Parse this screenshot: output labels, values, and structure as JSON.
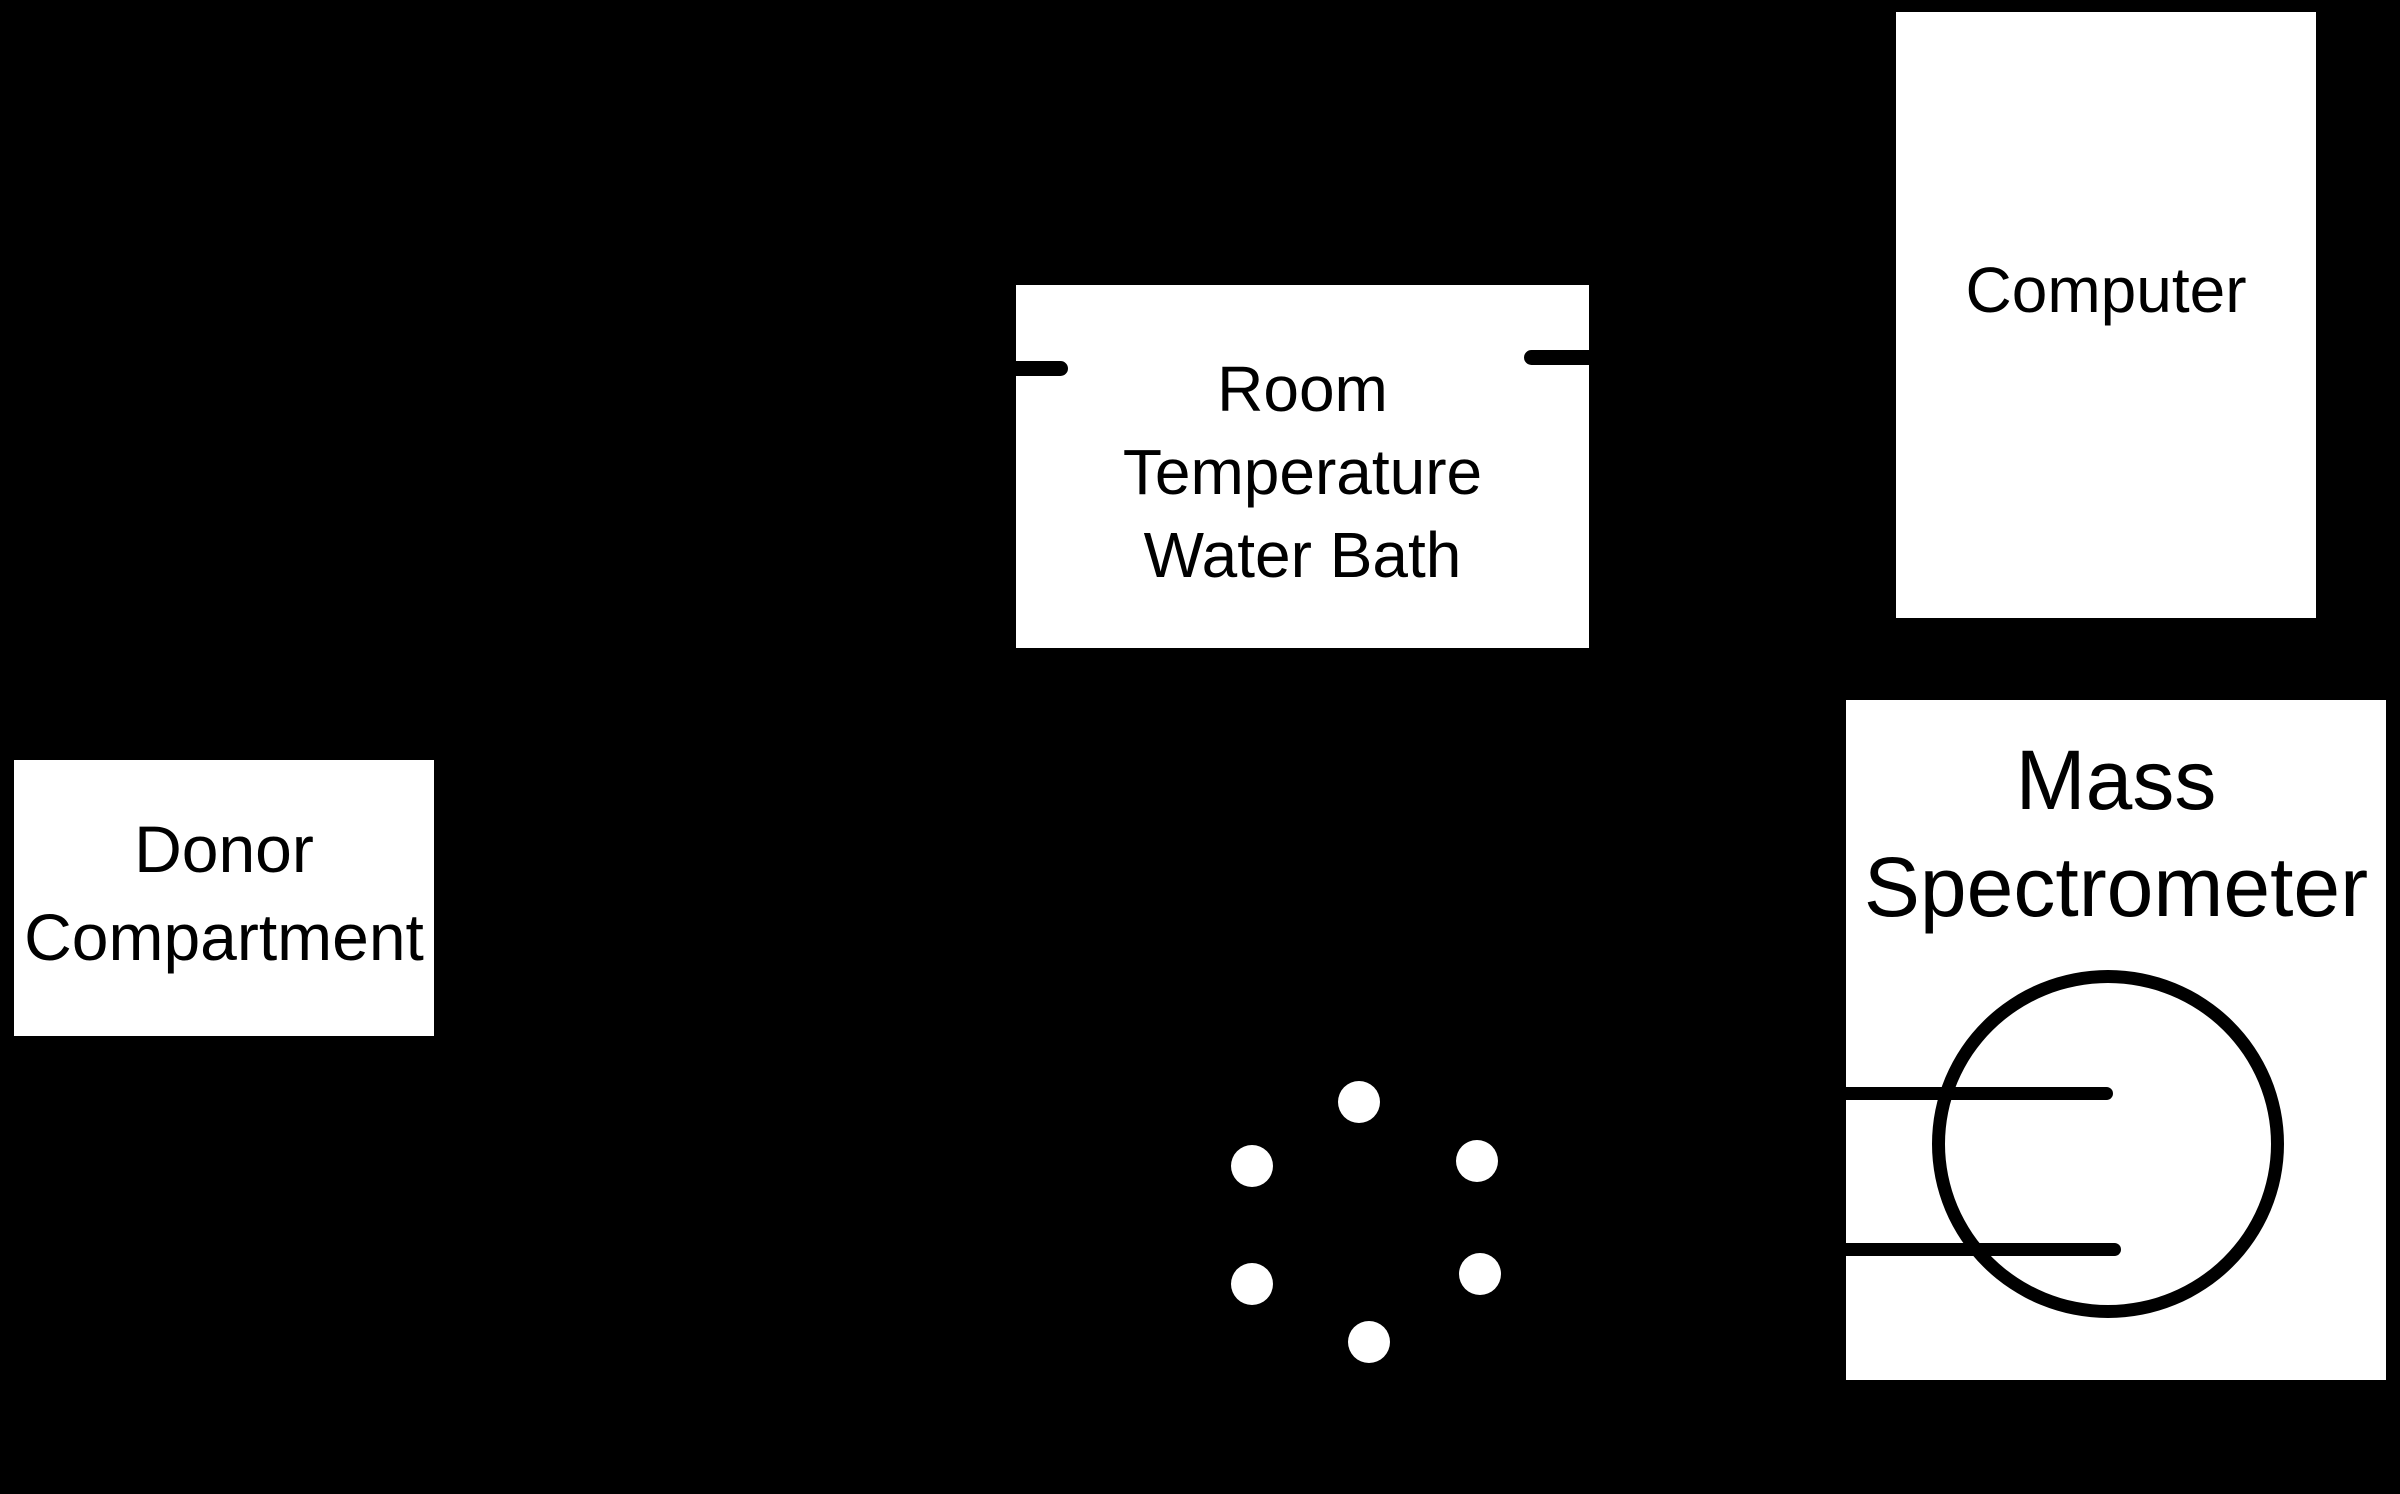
{
  "diagram": {
    "title": "Experimental setup schematic",
    "colors": {
      "background": "#000000",
      "box_fill": "#ffffff",
      "ink": "#000000"
    },
    "boxes": {
      "donor_compartment": {
        "lines": [
          "Donor",
          "Compartment"
        ]
      },
      "water_bath": {
        "lines": [
          "Room",
          "Temperature",
          "Water Bath"
        ]
      },
      "computer": {
        "lines": [
          "Computer"
        ]
      },
      "mass_spectrometer": {
        "lines": [
          "Mass",
          "Spectrometer"
        ]
      }
    },
    "sample_dots": {
      "radius": 21,
      "centers": [
        {
          "x": 1359,
          "y": 1102
        },
        {
          "x": 1252,
          "y": 1166
        },
        {
          "x": 1477,
          "y": 1161
        },
        {
          "x": 1252,
          "y": 1284
        },
        {
          "x": 1480,
          "y": 1274
        },
        {
          "x": 1369,
          "y": 1342
        }
      ]
    }
  }
}
